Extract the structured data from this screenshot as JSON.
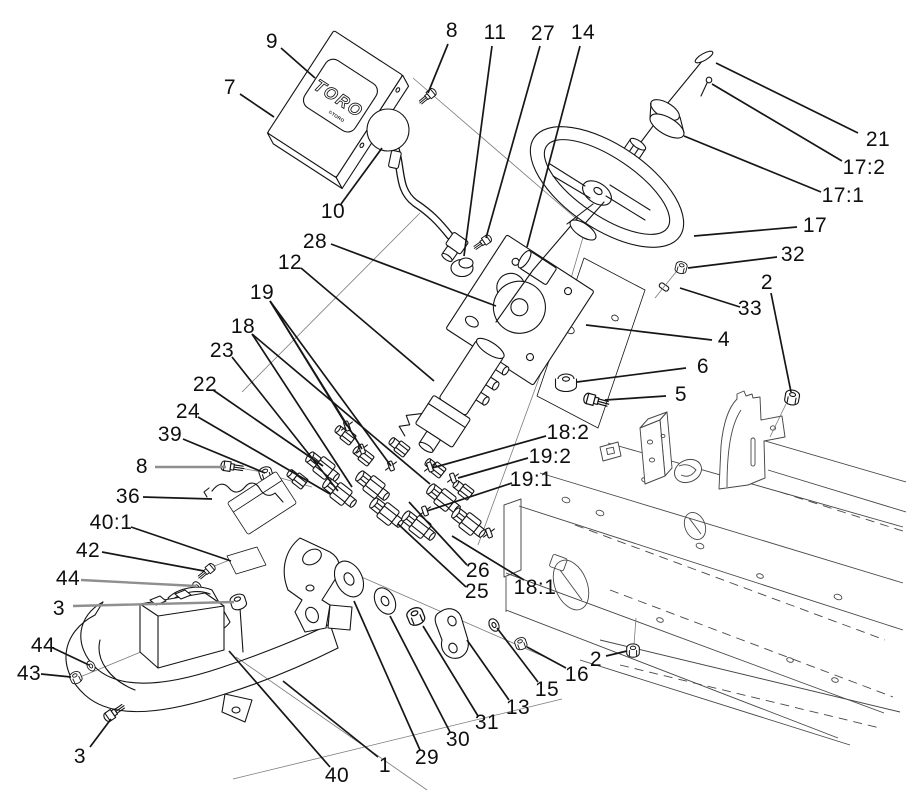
{
  "window": {
    "width": 906,
    "height": 792,
    "background": "#ffffff"
  },
  "diagram": {
    "kind": "exploded-parts-diagram",
    "line_color": "#141414",
    "frame_line_color": "#474747",
    "leader_color": "#161616",
    "gray_leader_color": "#8f8f8f",
    "label_color": "#0f0f0f",
    "label_font_size_px": 21
  },
  "logo": {
    "brand": "TORO",
    "mark": "©TORO"
  },
  "callouts": [
    {
      "label": "9",
      "x": 272,
      "y": 42,
      "leaders": [
        [
          281,
          48,
          315,
          78
        ]
      ]
    },
    {
      "label": "7",
      "x": 230,
      "y": 88,
      "leaders": [
        [
          240,
          94,
          274,
          117
        ]
      ]
    },
    {
      "label": "8",
      "x": 452,
      "y": 31,
      "leaders": [
        [
          448,
          44,
          428,
          93
        ]
      ]
    },
    {
      "label": "11",
      "x": 495,
      "y": 33,
      "leaders": [
        [
          492,
          46,
          464,
          256
        ]
      ]
    },
    {
      "label": "27",
      "x": 543,
      "y": 34,
      "leaders": [
        [
          540,
          46,
          486,
          238
        ]
      ]
    },
    {
      "label": "14",
      "x": 583,
      "y": 33,
      "leaders": [
        [
          580,
          46,
          527,
          247
        ]
      ]
    },
    {
      "label": "10",
      "x": 333,
      "y": 212,
      "leaders": [
        [
          341,
          204,
          382,
          148
        ]
      ]
    },
    {
      "label": "21",
      "x": 878,
      "y": 140,
      "leaders": [
        [
          858,
          133,
          716,
          63
        ]
      ]
    },
    {
      "label": "17:2",
      "x": 864,
      "y": 168,
      "leaders": [
        [
          842,
          161,
          712,
          84
        ]
      ]
    },
    {
      "label": "17:1",
      "x": 843,
      "y": 196,
      "leaders": [
        [
          821,
          192,
          684,
          136
        ]
      ]
    },
    {
      "label": "17",
      "x": 815,
      "y": 226,
      "leaders": [
        [
          797,
          227,
          694,
          236
        ]
      ]
    },
    {
      "label": "32",
      "x": 793,
      "y": 255,
      "leaders": [
        [
          777,
          257,
          688,
          268
        ]
      ]
    },
    {
      "label": "2",
      "x": 767,
      "y": 283,
      "leaders": [
        [
          771,
          293,
          791,
          392
        ]
      ]
    },
    {
      "label": "33",
      "x": 750,
      "y": 309,
      "leaders": [
        [
          740,
          307,
          680,
          288
        ]
      ]
    },
    {
      "label": "4",
      "x": 724,
      "y": 340,
      "leaders": [
        [
          712,
          340,
          586,
          325
        ]
      ]
    },
    {
      "label": "6",
      "x": 703,
      "y": 367,
      "leaders": [
        [
          686,
          368,
          577,
          382
        ]
      ]
    },
    {
      "label": "5",
      "x": 681,
      "y": 395,
      "leaders": [
        [
          666,
          396,
          605,
          400
        ]
      ]
    },
    {
      "label": "28",
      "x": 315,
      "y": 242,
      "leaders": [
        [
          331,
          244,
          496,
          306
        ]
      ]
    },
    {
      "label": "12",
      "x": 290,
      "y": 263,
      "leaders": [
        [
          301,
          268,
          434,
          381
        ]
      ]
    },
    {
      "label": "19",
      "x": 262,
      "y": 293,
      "leaders": [
        [
          270,
          301,
          347,
          426
        ],
        [
          270,
          301,
          362,
          449
        ],
        [
          270,
          301,
          391,
          466
        ]
      ]
    },
    {
      "label": "18",
      "x": 243,
      "y": 327,
      "leaders": [
        [
          252,
          334,
          352,
          487
        ],
        [
          252,
          334,
          430,
          484
        ]
      ]
    },
    {
      "label": "23",
      "x": 222,
      "y": 351,
      "leaders": [
        [
          232,
          357,
          338,
          491
        ]
      ]
    },
    {
      "label": "22",
      "x": 205,
      "y": 385,
      "leaders": [
        [
          213,
          390,
          323,
          466
        ]
      ]
    },
    {
      "label": "24",
      "x": 188,
      "y": 412,
      "leaders": [
        [
          198,
          417,
          330,
          494
        ]
      ]
    },
    {
      "label": "39",
      "x": 170,
      "y": 435,
      "leaders": [
        [
          183,
          439,
          265,
          473
        ]
      ]
    },
    {
      "label": "8",
      "x": 142,
      "y": 467,
      "gray": true,
      "leaders": [
        [
          155,
          467,
          226,
          467
        ]
      ]
    },
    {
      "label": "36",
      "x": 128,
      "y": 497,
      "leaders": [
        [
          143,
          497,
          212,
          499
        ]
      ]
    },
    {
      "label": "40:1",
      "x": 111,
      "y": 523,
      "leaders": [
        [
          131,
          527,
          231,
          561
        ]
      ]
    },
    {
      "label": "42",
      "x": 88,
      "y": 551,
      "leaders": [
        [
          102,
          552,
          204,
          571
        ]
      ]
    },
    {
      "label": "44",
      "x": 68,
      "y": 579,
      "gray": true,
      "leaders": [
        [
          81,
          580,
          196,
          586
        ]
      ]
    },
    {
      "label": "3",
      "x": 59,
      "y": 609,
      "gray": true,
      "leaders": [
        [
          73,
          606,
          234,
          602
        ]
      ]
    },
    {
      "label": "44",
      "x": 43,
      "y": 646,
      "leaders": [
        [
          53,
          648,
          89,
          665
        ]
      ]
    },
    {
      "label": "43",
      "x": 29,
      "y": 674,
      "leaders": [
        [
          41,
          674,
          71,
          677
        ]
      ]
    },
    {
      "label": "3",
      "x": 80,
      "y": 757,
      "leaders": [
        [
          90,
          747,
          111,
          719
        ]
      ]
    },
    {
      "label": "18:2",
      "x": 568,
      "y": 433,
      "leaders": [
        [
          546,
          436,
          432,
          468
        ]
      ]
    },
    {
      "label": "19:2",
      "x": 550,
      "y": 457,
      "leaders": [
        [
          528,
          458,
          458,
          478
        ]
      ]
    },
    {
      "label": "19:1",
      "x": 531,
      "y": 480,
      "leaders": [
        [
          512,
          483,
          427,
          511
        ]
      ]
    },
    {
      "label": "26",
      "x": 478,
      "y": 571,
      "leaders": [
        [
          467,
          565,
          409,
          502
        ]
      ]
    },
    {
      "label": "25",
      "x": 477,
      "y": 592,
      "leaders": [
        [
          466,
          587,
          398,
          524
        ]
      ]
    },
    {
      "label": "18:1",
      "x": 535,
      "y": 588,
      "leaders": [
        [
          524,
          580,
          452,
          536
        ]
      ]
    },
    {
      "label": "16",
      "x": 577,
      "y": 675,
      "leaders": [
        [
          566,
          668,
          527,
          647
        ]
      ]
    },
    {
      "label": "2",
      "x": 596,
      "y": 660,
      "leaders": [
        [
          606,
          656,
          627,
          651
        ]
      ]
    },
    {
      "label": "15",
      "x": 547,
      "y": 690,
      "leaders": [
        [
          538,
          682,
          497,
          628
        ]
      ]
    },
    {
      "label": "13",
      "x": 518,
      "y": 708,
      "leaders": [
        [
          509,
          700,
          467,
          640
        ]
      ]
    },
    {
      "label": "31",
      "x": 487,
      "y": 723,
      "leaders": [
        [
          478,
          716,
          423,
          626
        ]
      ]
    },
    {
      "label": "30",
      "x": 458,
      "y": 740,
      "leaders": [
        [
          450,
          732,
          390,
          616
        ]
      ]
    },
    {
      "label": "29",
      "x": 427,
      "y": 758,
      "leaders": [
        [
          420,
          750,
          354,
          601
        ]
      ]
    },
    {
      "label": "1",
      "x": 385,
      "y": 766,
      "leaders": [
        [
          378,
          757,
          283,
          681
        ]
      ]
    },
    {
      "label": "40",
      "x": 337,
      "y": 776,
      "leaders": [
        [
          330,
          767,
          229,
          651
        ]
      ]
    }
  ]
}
